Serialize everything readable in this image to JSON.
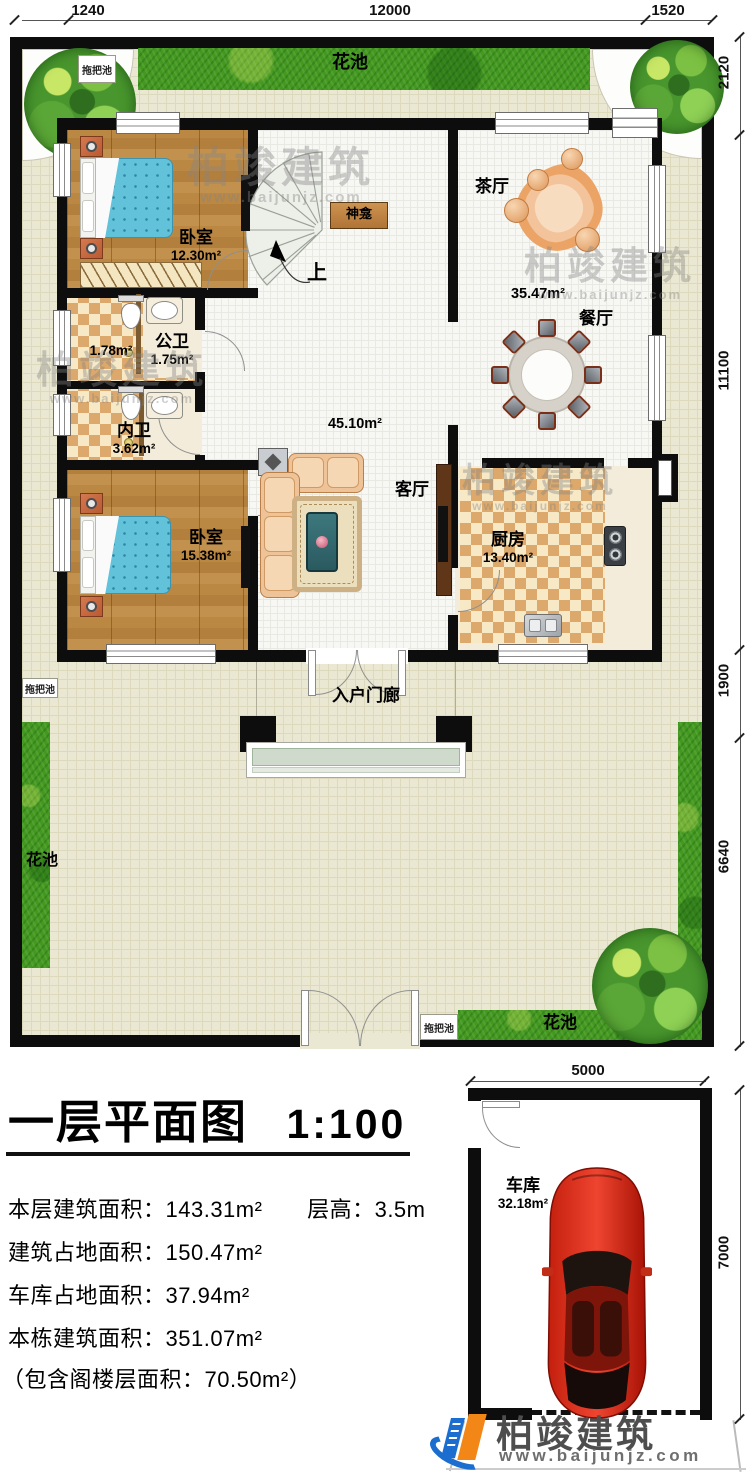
{
  "dims": {
    "top": {
      "d1": "1240",
      "d2": "12000",
      "d3": "1520"
    },
    "right": {
      "d1": "2120",
      "d2": "11100",
      "d3": "1900",
      "d4": "6640"
    },
    "garage": {
      "top": "5000",
      "right": "7000"
    }
  },
  "site": {
    "flower_bed": "花池",
    "mop_pool": "拖把池"
  },
  "rooms": {
    "bedroom1": {
      "name": "卧室",
      "area": "12.30m²"
    },
    "bedroom2": {
      "name": "卧室",
      "area": "15.38m²"
    },
    "public_wc": {
      "name": "公卫",
      "area": "1.75m²",
      "shower_area": "1.78m²"
    },
    "private_wc": {
      "name": "内卫",
      "area": "3.62m²"
    },
    "tea_hall": {
      "name": "茶厅"
    },
    "dining": {
      "name": "餐厅",
      "area": "35.47m²"
    },
    "living": {
      "name": "客厅",
      "area": "45.10m²"
    },
    "kitchen": {
      "name": "厨房",
      "area": "13.40m²"
    },
    "shrine": {
      "name": "神龛"
    },
    "stairs_up": "上",
    "porch": {
      "name": "入户门廊"
    },
    "garage": {
      "name": "车库",
      "area": "32.18m²"
    }
  },
  "title": {
    "main": "一层平面图",
    "scale": "1:100"
  },
  "stats": {
    "s1a": "本层建筑面积：143.31m²",
    "s1b": "层高：3.5m",
    "s2": "建筑占地面积：150.47m²",
    "s3": "车库占地面积：37.94m²",
    "s4": "本栋建筑面积：351.07m²",
    "s5": "（包含阁楼层面积：70.50m²）"
  },
  "brand": {
    "name": "柏竣建筑",
    "url": "www.baijunjz.com"
  }
}
